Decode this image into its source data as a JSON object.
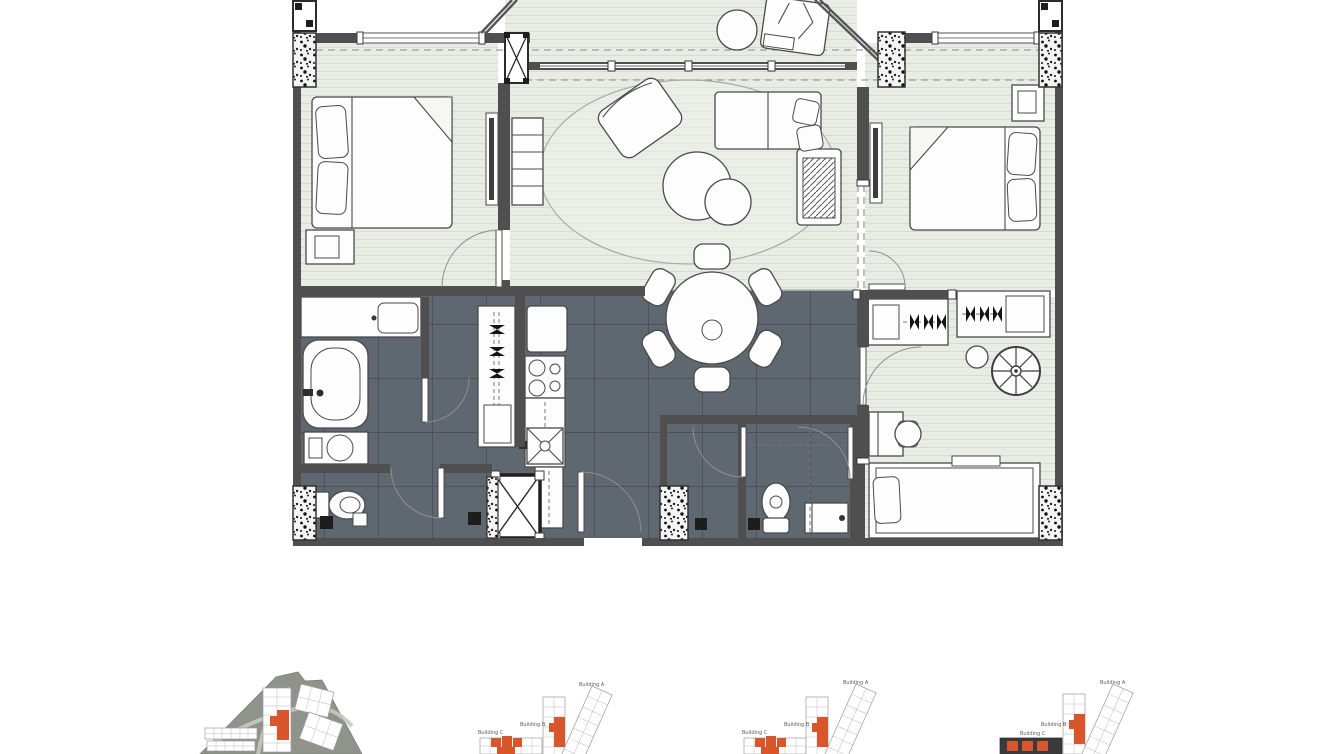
{
  "colors": {
    "accent_orange": "#d9562c",
    "wall_gray": "#4f4f4f",
    "tile_dark": "#5f6770",
    "tile_grout": "#4c525a",
    "floor_light": "#e9ebe5",
    "plank_line": "#d8dbd4",
    "siteplan_ground": "#8f938b",
    "siteplan_road": "#c6c9c0",
    "furniture_outline": "#4a4a4a",
    "siteplan_dark_building": "#3a3a3a"
  },
  "thumbnails": {
    "clusters": [
      {
        "building_a": "Building A",
        "building_b": "Building B",
        "building_c": "Building C"
      },
      {
        "building_a": "Building A",
        "building_b": "Building B",
        "building_c": "Building C"
      },
      {
        "building_a": "Building A",
        "building_b": "Building B",
        "building_c": "Building C"
      }
    ]
  }
}
